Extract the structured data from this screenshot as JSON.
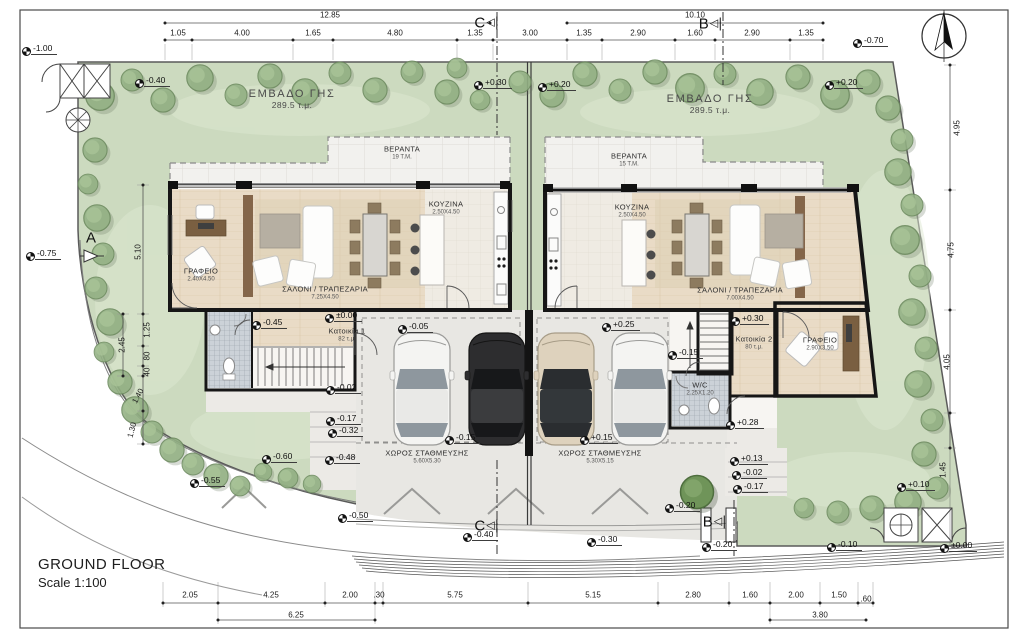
{
  "titles": {
    "main": "GROUND FLOOR",
    "scale": "Scale 1:100"
  },
  "plots": [
    {
      "name": "ΕΜΒΑΔΟ ΓΗΣ",
      "size": "289.5 τ.μ.",
      "x": 292,
      "y": 99
    },
    {
      "name": "ΕΜΒΑΔΟ ΓΗΣ",
      "size": "289.5 τ.μ.",
      "x": 710,
      "y": 104
    }
  ],
  "rooms": [
    {
      "name": "ΓΡΑΦΕΙΟ",
      "size": "2.40X4.50",
      "x": 201,
      "y": 275
    },
    {
      "name": "ΣΑΛΟΝΙ / ΤΡΑΠΕΖΑΡΙΑ",
      "size": "7.25X4.50",
      "x": 325,
      "y": 293
    },
    {
      "name": "ΚΟΥΖΙΝΑ",
      "size": "2.50X4.50",
      "x": 446,
      "y": 208
    },
    {
      "name": "ΒΕΡΑΝΤΑ",
      "size": "19 Τ.Μ.",
      "x": 402,
      "y": 153
    },
    {
      "name": "ΒΕΡΑΝΤΑ",
      "size": "15 Τ.Μ.",
      "x": 629,
      "y": 160
    },
    {
      "name": "ΚΟΥΖΙΝΑ",
      "size": "2.50X4.50",
      "x": 632,
      "y": 211
    },
    {
      "name": "ΣΑΛΟΝΙ / ΤΡΑΠΕΖΑΡΙΑ",
      "size": "7.00X4.50",
      "x": 740,
      "y": 294
    },
    {
      "name": "ΓΡΑΦΕΙΟ",
      "size": "2.90X3.50",
      "x": 820,
      "y": 344
    },
    {
      "name": "W/C",
      "size": "2.25X1.20",
      "x": 700,
      "y": 389
    },
    {
      "name": "Κατοικία 1",
      "size": "82 τ.μ.",
      "x": 347,
      "y": 335
    },
    {
      "name": "Κατοικία 2",
      "size": "80 τ.μ.",
      "x": 754,
      "y": 343
    },
    {
      "name": "ΧΩΡΟΣ ΣΤΑΘΜΕΥΣΗΣ",
      "size": "5.60X5.30",
      "x": 427,
      "y": 457
    },
    {
      "name": "ΧΩΡΟΣ ΣΤΑΘΜΕΥΣΗΣ",
      "size": "5.30X5.15",
      "x": 600,
      "y": 457
    }
  ],
  "levels": [
    {
      "v": "-1.00",
      "x": 27,
      "y": 52
    },
    {
      "v": "-0.40",
      "x": 140,
      "y": 84
    },
    {
      "v": "+0.30",
      "x": 479,
      "y": 86
    },
    {
      "v": "+0.20",
      "x": 543,
      "y": 88
    },
    {
      "v": "+0.20",
      "x": 830,
      "y": 86
    },
    {
      "v": "-0.70",
      "x": 858,
      "y": 44
    },
    {
      "v": "-0.75",
      "x": 31,
      "y": 257
    },
    {
      "v": "±0.00",
      "x": 330,
      "y": 319
    },
    {
      "v": "-0.45",
      "x": 257,
      "y": 326
    },
    {
      "v": "-0.05",
      "x": 403,
      "y": 330
    },
    {
      "v": "-0.02",
      "x": 331,
      "y": 391
    },
    {
      "v": "-0.17",
      "x": 331,
      "y": 422
    },
    {
      "v": "-0.32",
      "x": 333,
      "y": 434
    },
    {
      "v": "-0.48",
      "x": 330,
      "y": 461
    },
    {
      "v": "-0.15",
      "x": 450,
      "y": 441
    },
    {
      "v": "+0.15",
      "x": 585,
      "y": 441
    },
    {
      "v": "+0.25",
      "x": 607,
      "y": 328
    },
    {
      "v": "+0.30",
      "x": 736,
      "y": 322
    },
    {
      "v": "-0.15",
      "x": 673,
      "y": 356
    },
    {
      "v": "+0.28",
      "x": 731,
      "y": 426
    },
    {
      "v": "+0.13",
      "x": 735,
      "y": 462
    },
    {
      "v": "-0.02",
      "x": 737,
      "y": 476
    },
    {
      "v": "-0.17",
      "x": 738,
      "y": 490
    },
    {
      "v": "-0.20",
      "x": 670,
      "y": 509
    },
    {
      "v": "-0.20",
      "x": 707,
      "y": 548
    },
    {
      "v": "-0.30",
      "x": 592,
      "y": 543
    },
    {
      "v": "-0.40",
      "x": 468,
      "y": 538
    },
    {
      "v": "-0.10",
      "x": 832,
      "y": 548
    },
    {
      "v": "±0.00",
      "x": 945,
      "y": 549
    },
    {
      "v": "+0.10",
      "x": 902,
      "y": 488
    },
    {
      "v": "-0.55",
      "x": 195,
      "y": 484
    },
    {
      "v": "-0.60",
      "x": 267,
      "y": 460
    },
    {
      "v": "-0.50",
      "x": 343,
      "y": 519
    }
  ],
  "dims": [
    {
      "t": "12.85",
      "x": 330,
      "y": 15
    },
    {
      "t": "1.05",
      "x": 178,
      "y": 33
    },
    {
      "t": "4.00",
      "x": 242,
      "y": 33
    },
    {
      "t": "1.65",
      "x": 313,
      "y": 33
    },
    {
      "t": "4.80",
      "x": 395,
      "y": 33
    },
    {
      "t": "1.35",
      "x": 475,
      "y": 33
    },
    {
      "t": "3.00",
      "x": 530,
      "y": 33
    },
    {
      "t": "10.10",
      "x": 695,
      "y": 15
    },
    {
      "t": "1.35",
      "x": 584,
      "y": 33
    },
    {
      "t": "2.90",
      "x": 638,
      "y": 33
    },
    {
      "t": "1.60",
      "x": 695,
      "y": 33
    },
    {
      "t": "2.90",
      "x": 752,
      "y": 33
    },
    {
      "t": "1.35",
      "x": 806,
      "y": 33
    },
    {
      "t": "2.05",
      "x": 190,
      "y": 595
    },
    {
      "t": "4.25",
      "x": 271,
      "y": 595
    },
    {
      "t": "2.00",
      "x": 350,
      "y": 595
    },
    {
      "t": ".30",
      "x": 379,
      "y": 595
    },
    {
      "t": "5.75",
      "x": 455,
      "y": 595
    },
    {
      "t": "5.15",
      "x": 593,
      "y": 595
    },
    {
      "t": "2.80",
      "x": 693,
      "y": 595
    },
    {
      "t": "1.60",
      "x": 750,
      "y": 595
    },
    {
      "t": "2.00",
      "x": 796,
      "y": 595
    },
    {
      "t": "1.50",
      "x": 839,
      "y": 595
    },
    {
      "t": ".60",
      "x": 866,
      "y": 599
    },
    {
      "t": "6.25",
      "x": 296,
      "y": 615
    },
    {
      "t": "3.80",
      "x": 820,
      "y": 615
    },
    {
      "t": "5.10",
      "x": 138,
      "y": 252,
      "r": -90
    },
    {
      "t": "2.45",
      "x": 122,
      "y": 345,
      "r": -90
    },
    {
      "t": "1.25",
      "x": 147,
      "y": 330,
      "r": -90
    },
    {
      "t": "80",
      "x": 147,
      "y": 356,
      "r": -90
    },
    {
      "t": "40",
      "x": 147,
      "y": 372,
      "r": -90
    },
    {
      "t": "1.40",
      "x": 138,
      "y": 396,
      "r": -62
    },
    {
      "t": "1.30",
      "x": 132,
      "y": 430,
      "r": -75
    },
    {
      "t": "4.95",
      "x": 957,
      "y": 128,
      "r": -90
    },
    {
      "t": "4.75",
      "x": 951,
      "y": 250,
      "r": -90
    },
    {
      "t": "4.05",
      "x": 947,
      "y": 362,
      "r": -90
    },
    {
      "t": "1.45",
      "x": 943,
      "y": 470,
      "r": -90
    }
  ],
  "sections": [
    {
      "t": "C",
      "x": 486,
      "y": 23,
      "tri": true
    },
    {
      "t": "B",
      "x": 710,
      "y": 24,
      "tri": true
    },
    {
      "t": "C",
      "x": 486,
      "y": 526,
      "tri": true
    },
    {
      "t": "B",
      "x": 714,
      "y": 522,
      "tri": true
    },
    {
      "t": "A",
      "x": 91,
      "y": 238,
      "tri": false
    }
  ]
}
